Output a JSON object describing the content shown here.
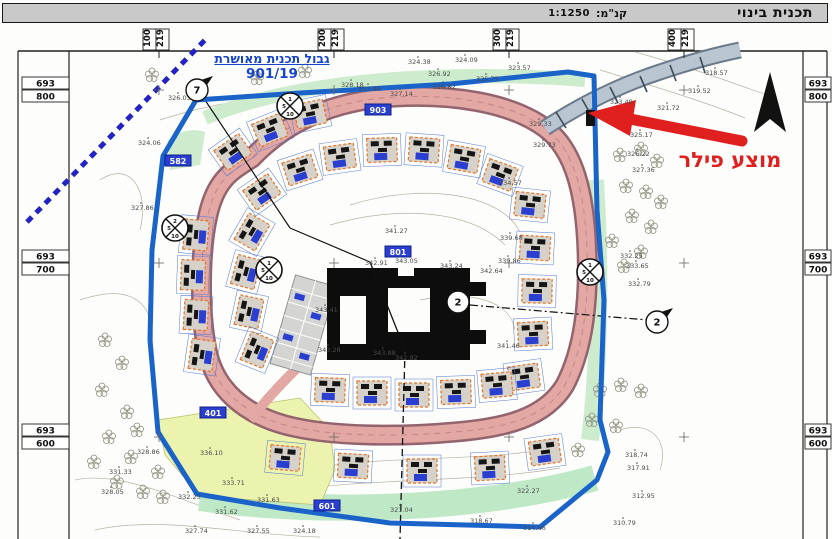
{
  "header": {
    "title": "תכנית בינוי",
    "scale_label": "קנ\"מ:",
    "scale_value": "1:1250"
  },
  "annotations": {
    "boundary_label_line1": "גבול תכנית מאושרת",
    "boundary_label_line2": "901/19",
    "pillar_label": "מוצע פילר"
  },
  "colors": {
    "boundary_blue": "#1a63c9",
    "road_pink": "#e3a8a4",
    "road_casing": "#93646e",
    "green_area": "#cdeccd",
    "yellow_green_area": "#ecf3ae",
    "house_outline_orange": "#e0762e",
    "label_blue": "#1545c8",
    "arrow_red": "#e01f1f",
    "building_black": "#0d0d0d"
  },
  "map": {
    "coordinates": {
      "top": [
        {
          "x": 159,
          "a": "219",
          "b": "100"
        },
        {
          "x": 334,
          "a": "219",
          "b": "200"
        },
        {
          "x": 509,
          "a": "219",
          "b": "300"
        },
        {
          "x": 684,
          "a": "219",
          "b": "400"
        }
      ],
      "side": [
        {
          "y": 90,
          "a": "693",
          "b": "800"
        },
        {
          "y": 263,
          "a": "693",
          "b": "700"
        },
        {
          "y": 437,
          "a": "693",
          "b": "600"
        }
      ]
    },
    "road_labels": [
      {
        "x": 178,
        "y": 162,
        "t": "582"
      },
      {
        "x": 378,
        "y": 111,
        "t": "903"
      },
      {
        "x": 398,
        "y": 253,
        "t": "801"
      },
      {
        "x": 213,
        "y": 414,
        "t": "401"
      },
      {
        "x": 327,
        "y": 507,
        "t": "601"
      }
    ],
    "circle_markers": [
      {
        "x": 197,
        "y": 90,
        "n": "7"
      },
      {
        "x": 458,
        "y": 302,
        "n": "2"
      },
      {
        "x": 657,
        "y": 322,
        "n": "2"
      }
    ],
    "section_markers": [
      {
        "x": 175,
        "y": 228,
        "n1": "2",
        "n2": "5",
        "n3": "10"
      },
      {
        "x": 290,
        "y": 106,
        "n1": "1",
        "n2": "5",
        "n3": "10"
      },
      {
        "x": 590,
        "y": 272,
        "n1": "1",
        "n2": "5",
        "n3": "10"
      },
      {
        "x": 269,
        "y": 270,
        "n1": "1",
        "n2": "5",
        "n3": "10"
      }
    ],
    "elevation_labels": [
      {
        "x": 168,
        "y": 100,
        "t": "326.03"
      },
      {
        "x": 408,
        "y": 64,
        "t": "324.38"
      },
      {
        "x": 455,
        "y": 62,
        "t": "324.09"
      },
      {
        "x": 508,
        "y": 70,
        "t": "323.57"
      },
      {
        "x": 476,
        "y": 81,
        "t": "325.77"
      },
      {
        "x": 428,
        "y": 76,
        "t": "326.92"
      },
      {
        "x": 433,
        "y": 89,
        "t": "326.82"
      },
      {
        "x": 341,
        "y": 87,
        "t": "328.18"
      },
      {
        "x": 358,
        "y": 91,
        "t": "327.94"
      },
      {
        "x": 390,
        "y": 96,
        "t": "327.14"
      },
      {
        "x": 138,
        "y": 145,
        "t": "324.06"
      },
      {
        "x": 131,
        "y": 210,
        "t": "327.86"
      },
      {
        "x": 705,
        "y": 75,
        "t": "318.57"
      },
      {
        "x": 688,
        "y": 93,
        "t": "319.52"
      },
      {
        "x": 610,
        "y": 104,
        "t": "323.49"
      },
      {
        "x": 657,
        "y": 110,
        "t": "321.72"
      },
      {
        "x": 630,
        "y": 137,
        "t": "325.17"
      },
      {
        "x": 627,
        "y": 156,
        "t": "326.22"
      },
      {
        "x": 632,
        "y": 172,
        "t": "327.36"
      },
      {
        "x": 529,
        "y": 126,
        "t": "329.33"
      },
      {
        "x": 533,
        "y": 147,
        "t": "329.73"
      },
      {
        "x": 499,
        "y": 185,
        "t": "334.57"
      },
      {
        "x": 500,
        "y": 240,
        "t": "339.68"
      },
      {
        "x": 498,
        "y": 263,
        "t": "339.86"
      },
      {
        "x": 620,
        "y": 258,
        "t": "332.25"
      },
      {
        "x": 626,
        "y": 268,
        "t": "333.65"
      },
      {
        "x": 628,
        "y": 286,
        "t": "332.79"
      },
      {
        "x": 385,
        "y": 233,
        "t": "341.27"
      },
      {
        "x": 395,
        "y": 263,
        "t": "343.05"
      },
      {
        "x": 440,
        "y": 268,
        "t": "343.24"
      },
      {
        "x": 480,
        "y": 273,
        "t": "342.64"
      },
      {
        "x": 365,
        "y": 265,
        "t": "342.91"
      },
      {
        "x": 315,
        "y": 312,
        "t": "343.41"
      },
      {
        "x": 318,
        "y": 352,
        "t": "343.28"
      },
      {
        "x": 373,
        "y": 355,
        "t": "343.88"
      },
      {
        "x": 395,
        "y": 360,
        "t": "342.92"
      },
      {
        "x": 497,
        "y": 348,
        "t": "341.46"
      },
      {
        "x": 200,
        "y": 455,
        "t": "336.10"
      },
      {
        "x": 222,
        "y": 485,
        "t": "333.71"
      },
      {
        "x": 109,
        "y": 474,
        "t": "331.33"
      },
      {
        "x": 178,
        "y": 499,
        "t": "332.25"
      },
      {
        "x": 257,
        "y": 502,
        "t": "331.63"
      },
      {
        "x": 215,
        "y": 514,
        "t": "331.62"
      },
      {
        "x": 185,
        "y": 533,
        "t": "327.74"
      },
      {
        "x": 247,
        "y": 533,
        "t": "327.55"
      },
      {
        "x": 293,
        "y": 533,
        "t": "324.18"
      },
      {
        "x": 390,
        "y": 512,
        "t": "321.04"
      },
      {
        "x": 517,
        "y": 493,
        "t": "322.27"
      },
      {
        "x": 470,
        "y": 523,
        "t": "318.67"
      },
      {
        "x": 523,
        "y": 530,
        "t": "314.46"
      },
      {
        "x": 625,
        "y": 457,
        "t": "318.74"
      },
      {
        "x": 627,
        "y": 470,
        "t": "317.91"
      },
      {
        "x": 632,
        "y": 498,
        "t": "312.95"
      },
      {
        "x": 613,
        "y": 525,
        "t": "310.79"
      },
      {
        "x": 137,
        "y": 454,
        "t": "328.86"
      },
      {
        "x": 101,
        "y": 494,
        "t": "328.05"
      }
    ],
    "houses": [
      [
        233,
        152,
        -35
      ],
      [
        270,
        130,
        -22
      ],
      [
        310,
        114,
        -12
      ],
      [
        196,
        235,
        -85
      ],
      [
        193,
        275,
        -88
      ],
      [
        196,
        315,
        -87
      ],
      [
        202,
        355,
        -82
      ],
      [
        262,
        192,
        -35
      ],
      [
        252,
        232,
        -60
      ],
      [
        246,
        272,
        -75
      ],
      [
        249,
        312,
        -78
      ],
      [
        257,
        350,
        -68
      ],
      [
        300,
        170,
        -18
      ],
      [
        340,
        157,
        -8
      ],
      [
        382,
        150,
        -2
      ],
      [
        424,
        150,
        4
      ],
      [
        464,
        159,
        10
      ],
      [
        500,
        175,
        20
      ],
      [
        530,
        205,
        6
      ],
      [
        535,
        248,
        3
      ],
      [
        537,
        291,
        1
      ],
      [
        533,
        334,
        -3
      ],
      [
        524,
        377,
        -8
      ],
      [
        330,
        390,
        2
      ],
      [
        372,
        393,
        0
      ],
      [
        414,
        395,
        0
      ],
      [
        456,
        392,
        -2
      ],
      [
        497,
        385,
        -5
      ],
      [
        285,
        458,
        5
      ],
      [
        353,
        466,
        3
      ],
      [
        422,
        471,
        0
      ],
      [
        490,
        468,
        -3
      ],
      [
        545,
        452,
        -8
      ]
    ],
    "trees": [
      [
        105,
        340
      ],
      [
        122,
        363
      ],
      [
        102,
        390
      ],
      [
        127,
        412
      ],
      [
        109,
        437
      ],
      [
        94,
        462
      ],
      [
        131,
        457
      ],
      [
        117,
        482
      ],
      [
        143,
        492
      ],
      [
        158,
        472
      ],
      [
        137,
        430
      ],
      [
        163,
        497
      ],
      [
        152,
        75
      ],
      [
        257,
        78
      ],
      [
        305,
        71
      ],
      [
        620,
        155
      ],
      [
        641,
        149
      ],
      [
        657,
        161
      ],
      [
        626,
        186
      ],
      [
        646,
        192
      ],
      [
        661,
        202
      ],
      [
        632,
        216
      ],
      [
        651,
        227
      ],
      [
        612,
        241
      ],
      [
        641,
        252
      ],
      [
        624,
        266
      ],
      [
        600,
        390
      ],
      [
        621,
        385
      ],
      [
        641,
        391
      ],
      [
        592,
        420
      ],
      [
        616,
        426
      ],
      [
        578,
        450
      ]
    ]
  }
}
